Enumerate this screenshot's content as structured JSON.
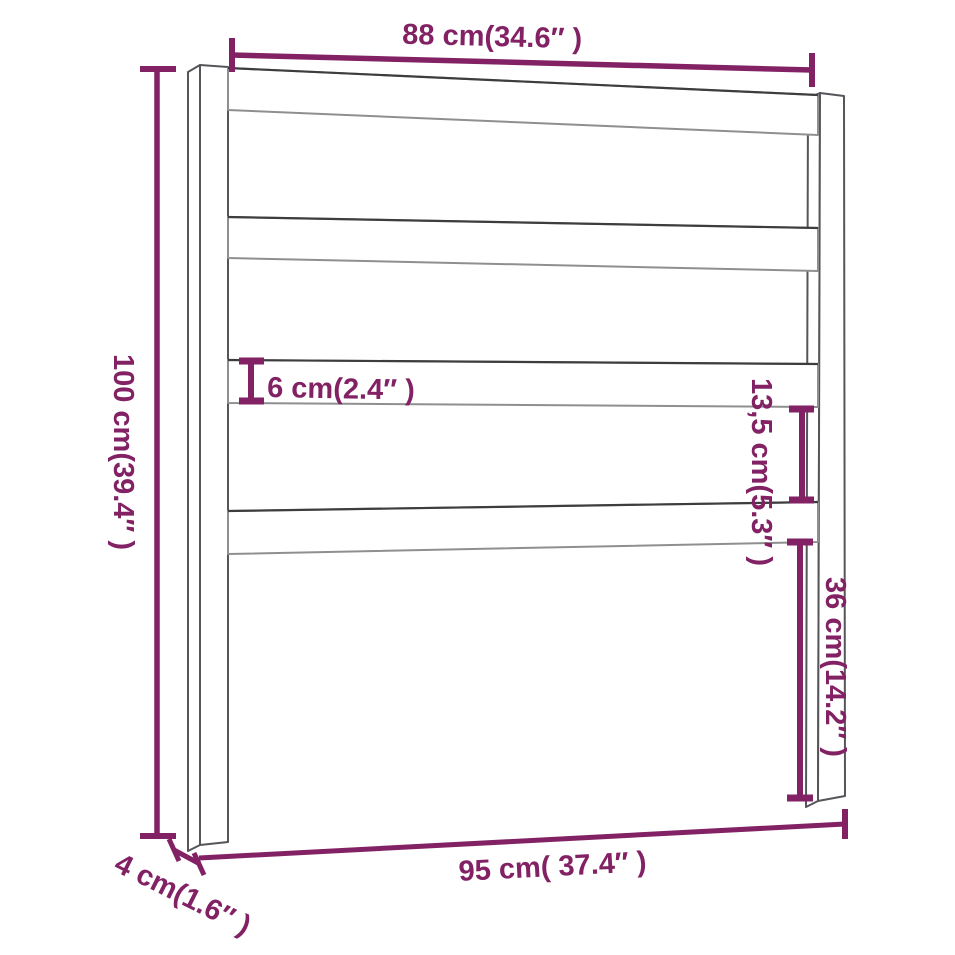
{
  "page": {
    "background": "#ffffff",
    "width": 955,
    "height": 955
  },
  "diagram": {
    "kind": "furniture-dimension-diagram",
    "subject": "headboard with two posts and four horizontal slats",
    "accent_color": "#822264",
    "outline_color": "#55565a",
    "labels": {
      "top_width": "88 cm(34.6″ )",
      "left_height": "100 cm(39.4″ )",
      "slat_thickness": "6 cm(2.4″ )",
      "slat_gap": "13,5 cm(5.3″ )",
      "lower_height": "36 cm(14.2″ )",
      "bottom_width": "95 cm( 37.4″ )",
      "post_depth": "4 cm(1.6″ )"
    }
  }
}
